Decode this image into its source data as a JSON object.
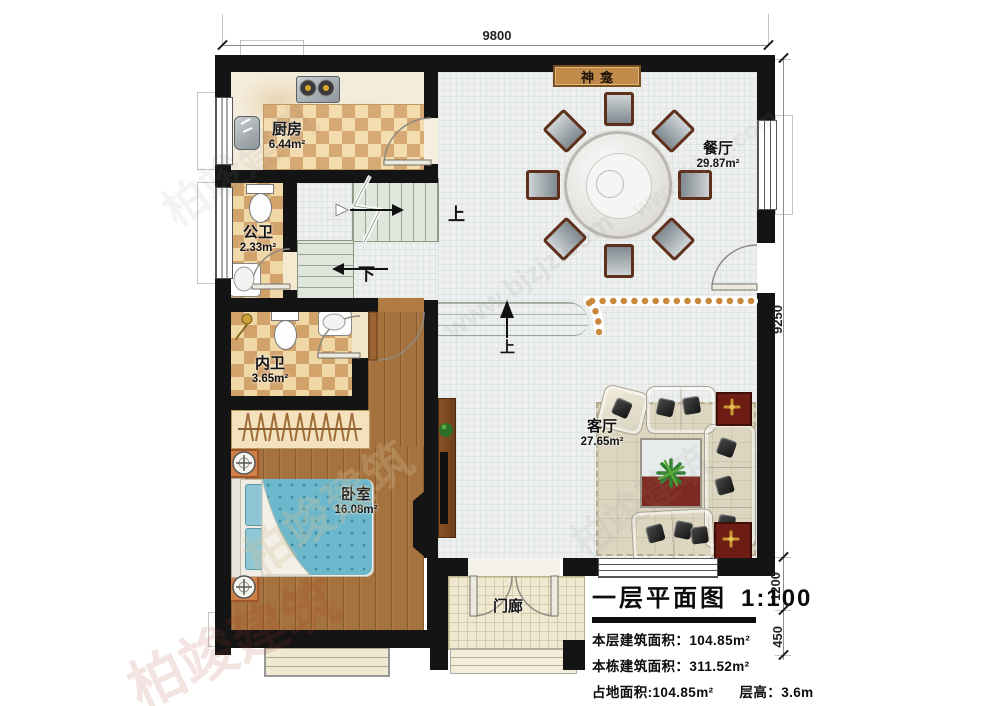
{
  "plan": {
    "rooms": {
      "kitchen": {
        "name": "厨房",
        "area": "6.44m²"
      },
      "public_bath": {
        "name": "公卫",
        "area": "2.33m²"
      },
      "inner_bath": {
        "name": "内卫",
        "area": "3.65m²"
      },
      "bedroom": {
        "name": "卧室",
        "area": "16.08m²"
      },
      "dining": {
        "name": "餐厅",
        "area": "29.87m²"
      },
      "living": {
        "name": "客厅",
        "area": "27.65m²"
      },
      "porch": {
        "name": "门廊"
      },
      "shrine": {
        "name": "神龛"
      }
    },
    "stairs": {
      "up_label": "上",
      "down_label": "下",
      "entry_step_label": "上"
    },
    "dimensions": {
      "width_top": "9800",
      "height_right": "9250",
      "porch_depth": "1200",
      "step_depth": "450"
    }
  },
  "title_block": {
    "title": "一层平面图",
    "scale": "1:100",
    "floor_area_label": "本层建筑面积：",
    "floor_area_value": "104.85m²",
    "building_area_label": "本栋建筑面积：",
    "building_area_value": "311.52m²",
    "footprint_label": "占地面积:",
    "footprint_value": "104.85m²",
    "height_label": "层高：",
    "height_value": "3.6m"
  },
  "watermark": {
    "brand": "柏竣建筑",
    "site": "www.bjzjz.com"
  },
  "colors": {
    "wall": "#141414",
    "checker_light": "#f0d7a6",
    "checker_dark": "#d2a26b",
    "wood_floor": "#a5713c",
    "blanket_blue": "#6cb7cb",
    "dot_accent": "#c8893c",
    "stair_green": "#e0e6dc",
    "red_table": "#6e1d14",
    "shrine_tan": "#c08a4a"
  }
}
